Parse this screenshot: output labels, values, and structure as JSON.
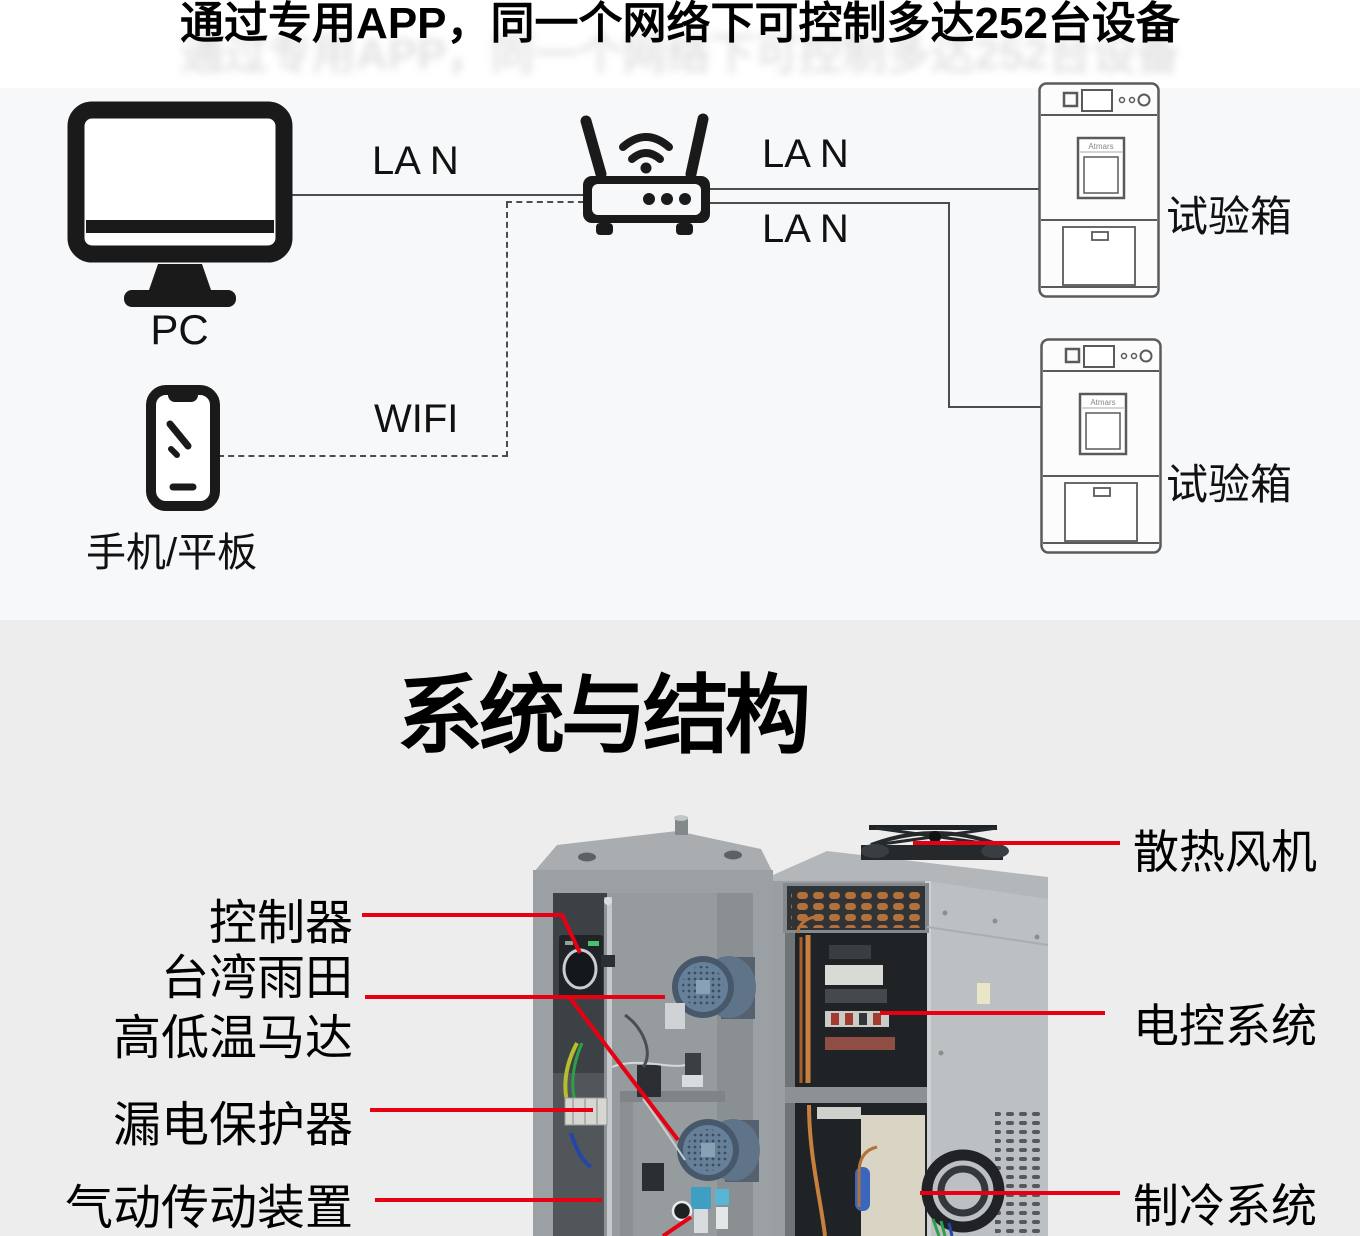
{
  "colors": {
    "accent_red": "#e60012",
    "top_bg": "#f7f8fa",
    "bottom_bg": "#eeeded",
    "diagram_line": "#4d4d4d",
    "icon_black": "#1a1a1a"
  },
  "header": {
    "title": "通过专用APP，同一个网络下可控制多达252台设备"
  },
  "network": {
    "pc_label": "PC",
    "phone_label": "手机/平板",
    "wifi_label": "WIFI",
    "lan_pc_router": "LA N",
    "lan_router_top": "LA N",
    "lan_router_bottom": "LA N",
    "chamber_top_label": "试验箱",
    "chamber_bottom_label": "试验箱",
    "chamber_brand": "Atmars"
  },
  "structure": {
    "heading": "系统与结构",
    "callouts_left": {
      "controller": "控制器",
      "motor_line1": "台湾雨田",
      "motor_line2": "高低温马达",
      "leakage_protector": "漏电保护器",
      "pneumatic_drive": "气动传动装置"
    },
    "callouts_right": {
      "cooling_fan": "散热风机",
      "electric_control": "电控系统",
      "refrigeration": "制冷系统"
    }
  }
}
